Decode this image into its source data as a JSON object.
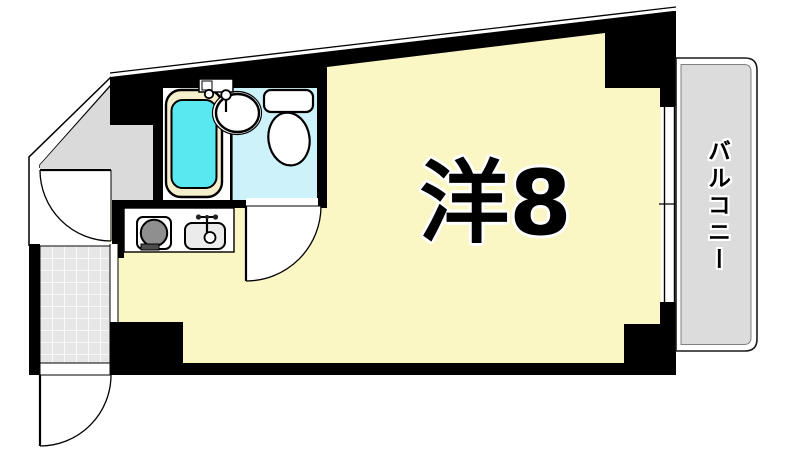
{
  "plan": {
    "rooms": {
      "main": {
        "label": "洋8"
      },
      "balcony": {
        "label": "バルコニー"
      }
    },
    "colors": {
      "room_fill": "#FBF7C4",
      "hall_fill": "#DADADA",
      "balcony_fill": "#DCDCDC",
      "tile_fill": "#E6E6E6",
      "bath_water": "#59E7F0",
      "bathtub_rim": "#F6EFCB",
      "toilet_floor": "#CDF2FA",
      "stove_burner": "#8F8F8F",
      "kitchen_sink": "#EBEBEB",
      "wall": "#000000"
    },
    "fixtures": [
      "bathtub",
      "washbasin",
      "toilet",
      "stove-burner",
      "kitchen-sink",
      "entrance-tiles",
      "window",
      "hinged-doors"
    ]
  }
}
